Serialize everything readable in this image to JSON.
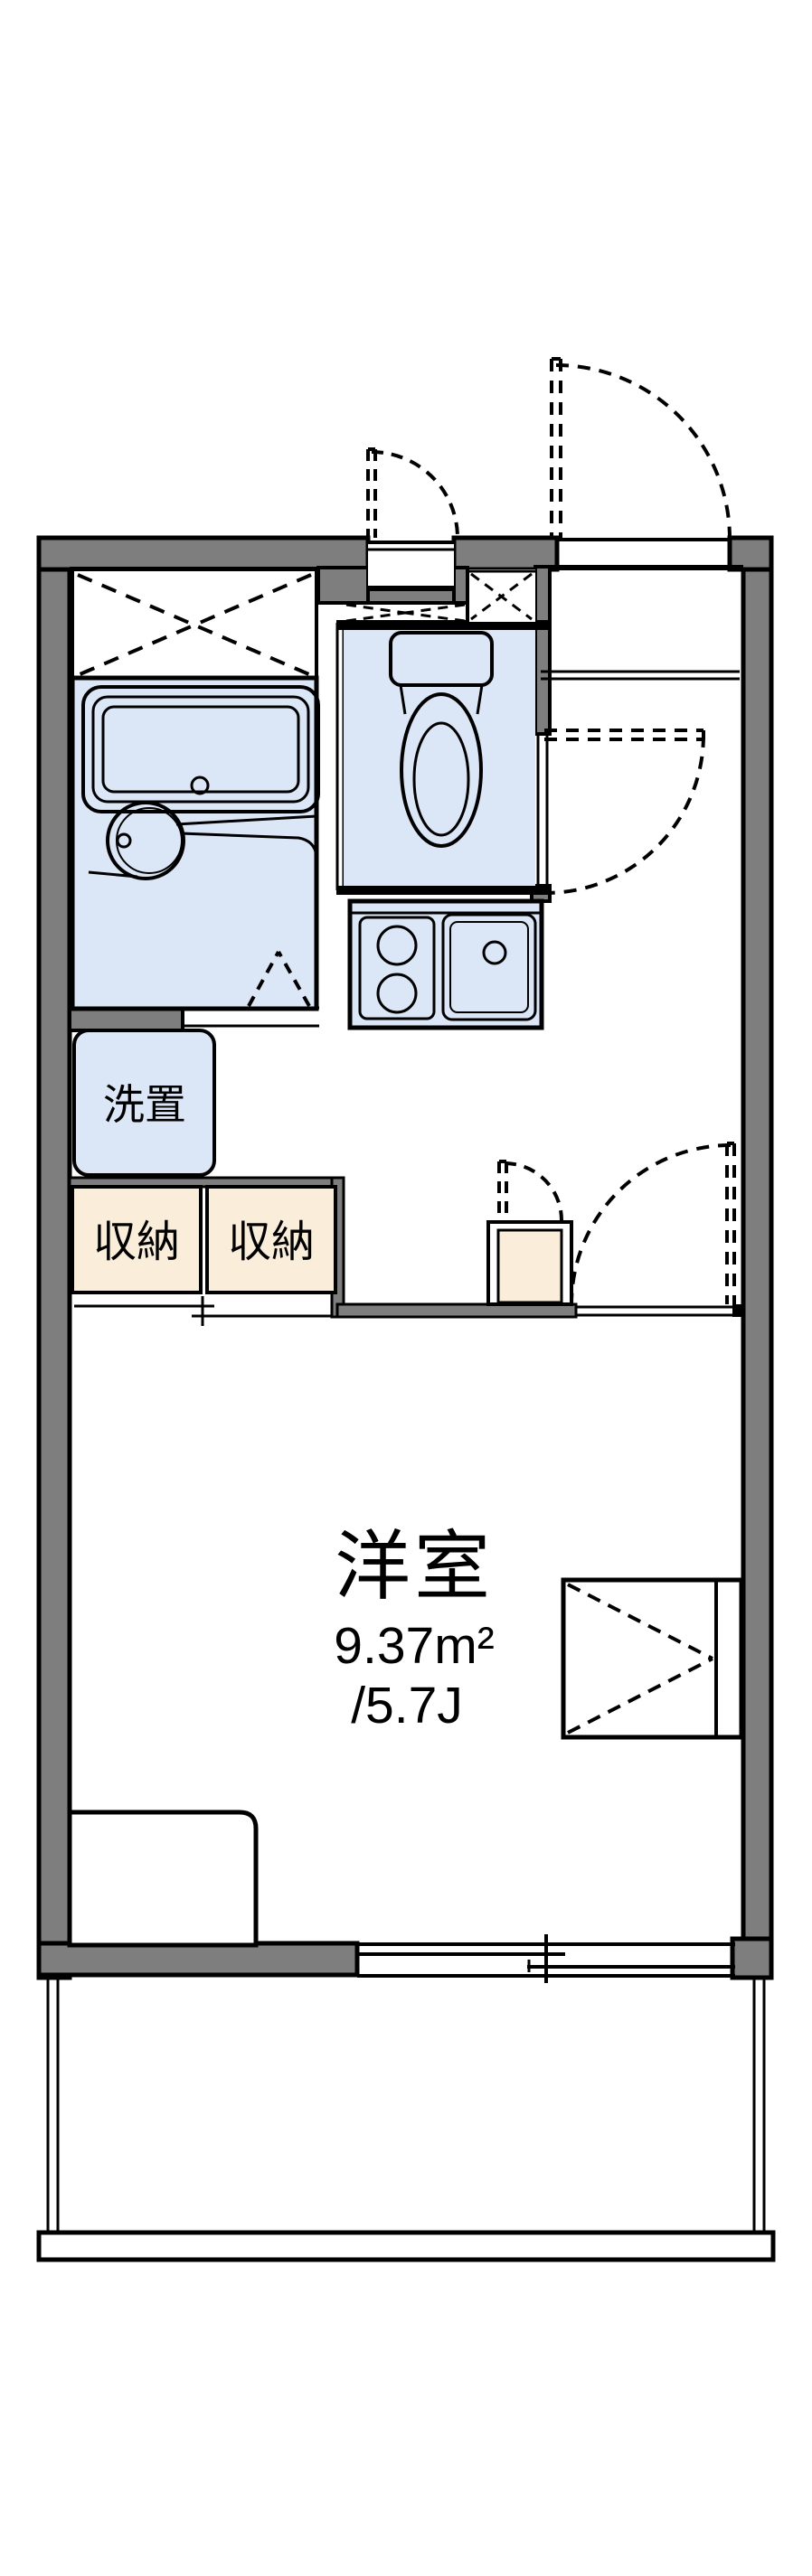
{
  "plan": {
    "type": "floor-plan",
    "description": "single-room Japanese apartment (1K) floor plan, portrait orientation",
    "labels": {
      "washer_space": "洗置",
      "storage_left": "収納",
      "storage_right": "収納"
    },
    "main_room": {
      "name": "洋室",
      "area_sqm": "9.37m²",
      "area_tatami": "/5.7J"
    },
    "colors": {
      "wall_gray": "#7e7e7e",
      "wet_area_blue": "#dbe6f6",
      "storage_cream": "#faeeda",
      "line_black": "#000000",
      "background_white": "#ffffff"
    },
    "fixtures": [
      "bathtub",
      "washbasin",
      "bath-folding-door",
      "toilet",
      "pipe-shaft",
      "kitchen-stove",
      "kitchen-sink",
      "entrance-door",
      "toilet-door",
      "room-door",
      "small-window",
      "storage-sliding-doors",
      "water-heater-column",
      "window-box",
      "bed-platform",
      "sliding-window",
      "balcony"
    ]
  }
}
